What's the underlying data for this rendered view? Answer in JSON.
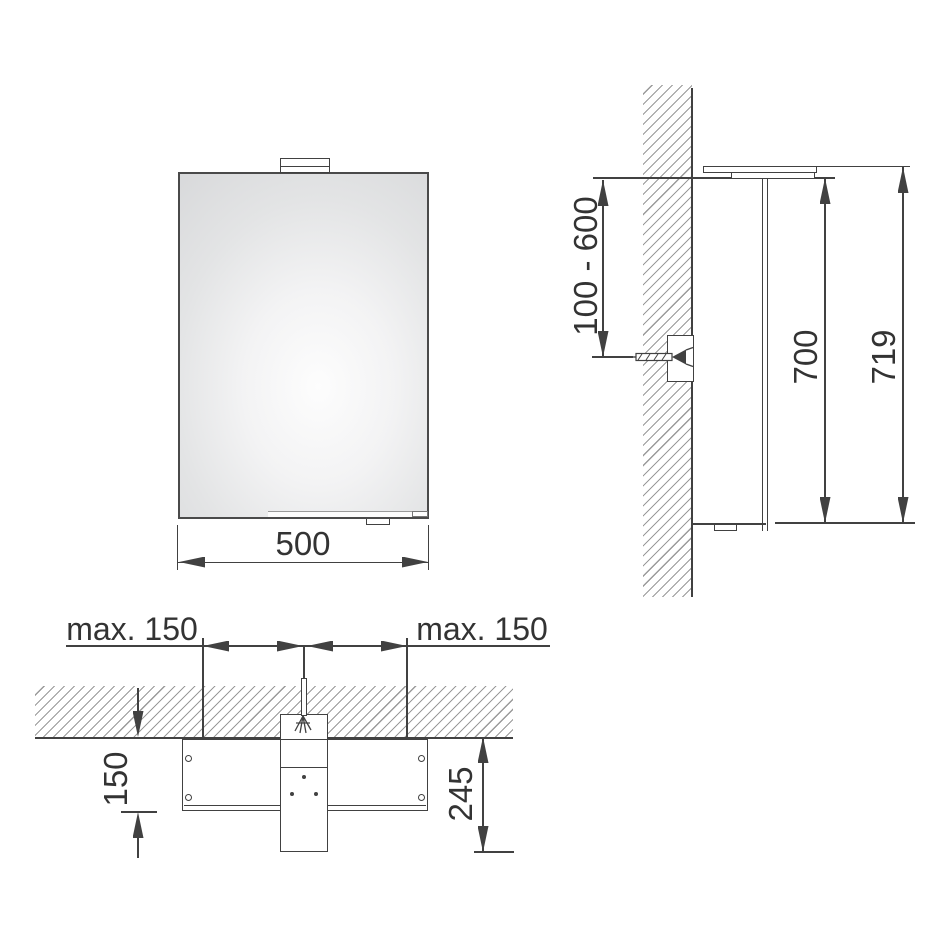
{
  "drawing": {
    "front_view": {
      "width_label": "500"
    },
    "side_view": {
      "mounting_range_label": "100 - 600",
      "cabinet_height_label": "700",
      "overall_height_label": "719"
    },
    "top_view": {
      "left_offset_label": "max. 150",
      "right_offset_label": "max. 150",
      "inset_depth_label": "150",
      "overall_depth_label": "245"
    }
  },
  "colors": {
    "line": "#414141",
    "hatch": "#9a9a9a",
    "label": "#333333",
    "bg": "#ffffff",
    "mirror_center": "#fdfdfd",
    "mirror_edge": "#d5d6d8"
  }
}
